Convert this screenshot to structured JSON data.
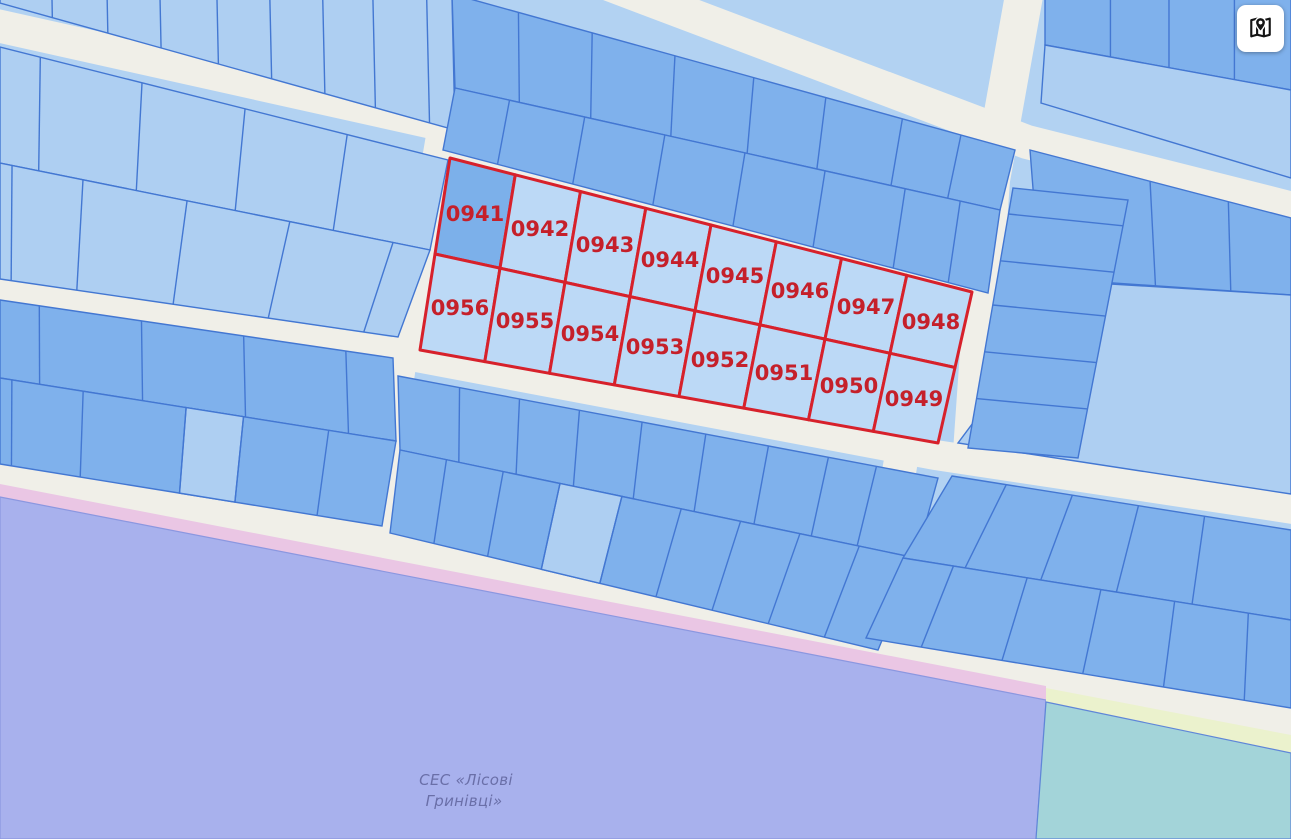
{
  "map": {
    "red_block": {
      "parcels": [
        {
          "label": "0941"
        },
        {
          "label": "0942"
        },
        {
          "label": "0943"
        },
        {
          "label": "0944"
        },
        {
          "label": "0945"
        },
        {
          "label": "0946"
        },
        {
          "label": "0947"
        },
        {
          "label": "0948"
        },
        {
          "label": "0949"
        },
        {
          "label": "0950"
        },
        {
          "label": "0951"
        },
        {
          "label": "0952"
        },
        {
          "label": "0953"
        },
        {
          "label": "0954"
        },
        {
          "label": "0955"
        },
        {
          "label": "0956"
        }
      ],
      "outline_color": "#d7212b",
      "label_color": "#c5202a",
      "cell_fill": "#bcd9f6",
      "highlight_cell": "0941",
      "highlight_fill": "#7cb0ea"
    },
    "region_label": {
      "line1": "СЕС «Лісові",
      "line2": "Гринівці»",
      "color": "#6a6fa8"
    },
    "colors": {
      "background": "#b2d2f2",
      "road": "#f0efe8",
      "parcel_light": "#aecff2",
      "parcel_medium": "#7fb1ec",
      "parcel_border": "#4377d2",
      "zone_purple": "#a8b1ed",
      "zone_purple_border": "#8b97e0",
      "zone_pink": "#eac6e4",
      "zone_teal": "#a3d4d9",
      "zone_teal_border": "#5f86d8",
      "zone_yellow": "#ebf2cd"
    }
  },
  "controls": {
    "map_button": {
      "icon": "map-location-icon"
    }
  }
}
